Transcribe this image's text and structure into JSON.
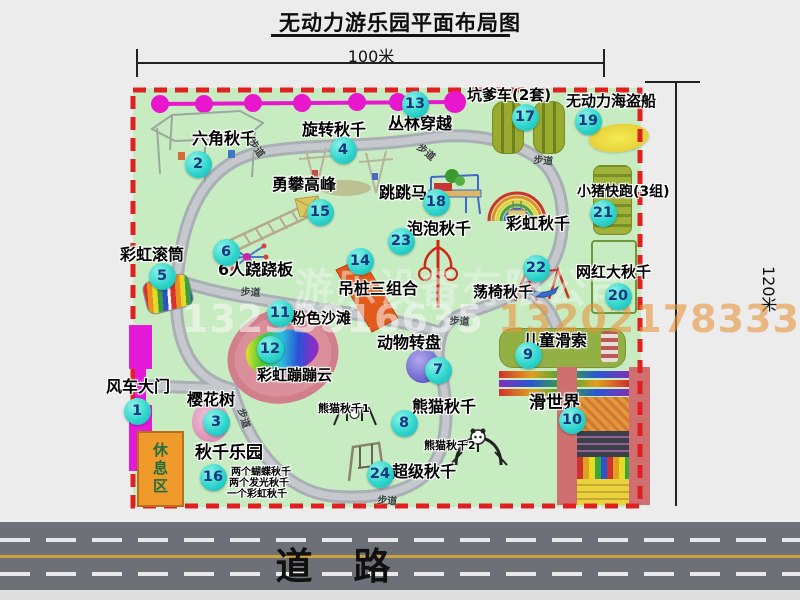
{
  "title": "无动力游乐园平面布局图",
  "dim_top": "100米",
  "dim_right": "120米",
  "road": {
    "label": "道 路"
  },
  "watermark": {
    "company": "游乐设备有限公司",
    "phone1": "13233816635",
    "phone2": "13202178333"
  },
  "rest_area": "休息区",
  "path_label_text": "步道",
  "colors": {
    "map_green": "#c8ecc2",
    "border_red": "#e02020",
    "zipline_magenta": "#e816cc",
    "gate_magenta": "#e41ad8",
    "rest_area_orange": "#f09a2c",
    "marker_fill": "#30d6cd",
    "marker_text": "#14387e",
    "road_gray": "#6e7078"
  },
  "attractions": [
    {
      "no": 1,
      "name": "风车大门",
      "marker": {
        "x": 137,
        "y": 411
      },
      "label": {
        "x": 106,
        "y": 378,
        "size": 16
      }
    },
    {
      "no": 2,
      "name": "六角秋千",
      "marker": {
        "x": 198,
        "y": 164
      },
      "label": {
        "x": 192,
        "y": 130,
        "size": 16
      }
    },
    {
      "no": 3,
      "name": "樱花树",
      "marker": {
        "x": 216,
        "y": 422
      },
      "label": {
        "x": 187,
        "y": 391,
        "size": 16
      }
    },
    {
      "no": 4,
      "name": "旋转秋千",
      "marker": {
        "x": 343,
        "y": 150
      },
      "label": {
        "x": 302,
        "y": 121,
        "size": 16
      }
    },
    {
      "no": 5,
      "name": "彩虹滚筒",
      "marker": {
        "x": 162,
        "y": 276
      },
      "label": {
        "x": 120,
        "y": 246,
        "size": 16
      }
    },
    {
      "no": 6,
      "name": "6人跷跷板",
      "marker": {
        "x": 226,
        "y": 252
      },
      "label": {
        "x": 218,
        "y": 261,
        "size": 16
      }
    },
    {
      "no": 7,
      "name": "动物转盘",
      "marker": {
        "x": 438,
        "y": 370
      },
      "label": {
        "x": 377,
        "y": 334,
        "size": 16
      }
    },
    {
      "no": 8,
      "name": "熊猫秋千",
      "marker": {
        "x": 404,
        "y": 423
      },
      "label": {
        "x": 412,
        "y": 398,
        "size": 16
      }
    },
    {
      "no": 9,
      "name": "儿童滑索",
      "marker": {
        "x": 528,
        "y": 355
      },
      "label": {
        "x": 523,
        "y": 332,
        "size": 16
      }
    },
    {
      "no": 10,
      "name": "滑世界",
      "marker": {
        "x": 572,
        "y": 420
      },
      "label": {
        "x": 529,
        "y": 394,
        "size": 17
      }
    },
    {
      "no": 11,
      "name": "粉色沙滩",
      "marker": {
        "x": 280,
        "y": 313
      },
      "label": {
        "x": 291,
        "y": 310,
        "size": 15
      }
    },
    {
      "no": 12,
      "name": "彩虹蹦蹦云",
      "marker": {
        "x": 270,
        "y": 349
      },
      "label": {
        "x": 257,
        "y": 367,
        "size": 15
      }
    },
    {
      "no": 13,
      "name": "丛林穿越",
      "marker": {
        "x": 415,
        "y": 104
      },
      "label": {
        "x": 388,
        "y": 115,
        "size": 16
      }
    },
    {
      "no": 14,
      "name": "吊桩三组合",
      "marker": {
        "x": 360,
        "y": 261
      },
      "label": {
        "x": 338,
        "y": 280,
        "size": 16
      }
    },
    {
      "no": 15,
      "name": "勇攀高峰",
      "marker": {
        "x": 320,
        "y": 212
      },
      "label": {
        "x": 272,
        "y": 176,
        "size": 16
      }
    },
    {
      "no": 16,
      "name": "秋千乐园",
      "marker": {
        "x": 213,
        "y": 477
      },
      "label": {
        "x": 195,
        "y": 444,
        "size": 17
      }
    },
    {
      "no": 17,
      "name": "坑爹车(2套)",
      "marker": {
        "x": 525,
        "y": 117
      },
      "label": {
        "x": 467,
        "y": 87,
        "size": 15
      }
    },
    {
      "no": 18,
      "name": "跳跳马",
      "marker": {
        "x": 436,
        "y": 202
      },
      "label": {
        "x": 379,
        "y": 184,
        "size": 16
      }
    },
    {
      "no": 19,
      "name": "无动力海盗船",
      "marker": {
        "x": 588,
        "y": 121
      },
      "label": {
        "x": 566,
        "y": 93,
        "size": 15
      }
    },
    {
      "no": 20,
      "name": "网红大秋千",
      "marker": {
        "x": 618,
        "y": 296
      },
      "label": {
        "x": 576,
        "y": 264,
        "size": 15
      }
    },
    {
      "no": 21,
      "name": "小猪快跑(3组)",
      "marker": {
        "x": 603,
        "y": 213
      },
      "label": {
        "x": 577,
        "y": 185,
        "size": 14
      }
    },
    {
      "no": 22,
      "name": "荡椅秋千",
      "marker": {
        "x": 536,
        "y": 268
      },
      "label": {
        "x": 473,
        "y": 284,
        "size": 15
      }
    },
    {
      "no": 23,
      "name": "泡泡秋千",
      "marker": {
        "x": 401,
        "y": 241
      },
      "label": {
        "x": 407,
        "y": 220,
        "size": 16
      }
    },
    {
      "no": 24,
      "name": "超级秋千",
      "marker": {
        "x": 380,
        "y": 474
      },
      "label": {
        "x": 392,
        "y": 463,
        "size": 16
      }
    }
  ],
  "extra_labels": [
    {
      "text": "彩虹秋千",
      "x": 506,
      "y": 215,
      "size": 16
    },
    {
      "text": "熊猫秋千1",
      "x": 318,
      "y": 403,
      "size": 11
    },
    {
      "text": "熊猫秋千2",
      "x": 424,
      "y": 440,
      "size": 11
    },
    {
      "text": "两个蝴蝶秋千",
      "x": 231,
      "y": 467,
      "size": 10
    },
    {
      "text": "两个发光秋千",
      "x": 229,
      "y": 478,
      "size": 10
    },
    {
      "text": "一个彩虹秋千",
      "x": 227,
      "y": 489,
      "size": 10
    }
  ],
  "path_labels": [
    {
      "x": 258,
      "y": 135,
      "rot": 55
    },
    {
      "x": 424,
      "y": 139,
      "rot": 40
    },
    {
      "x": 534,
      "y": 151,
      "rot": 5
    },
    {
      "x": 241,
      "y": 283,
      "rot": 3
    },
    {
      "x": 450,
      "y": 312,
      "rot": 3
    },
    {
      "x": 249,
      "y": 406,
      "rot": 72
    },
    {
      "x": 378,
      "y": 491,
      "rot": 5
    }
  ]
}
